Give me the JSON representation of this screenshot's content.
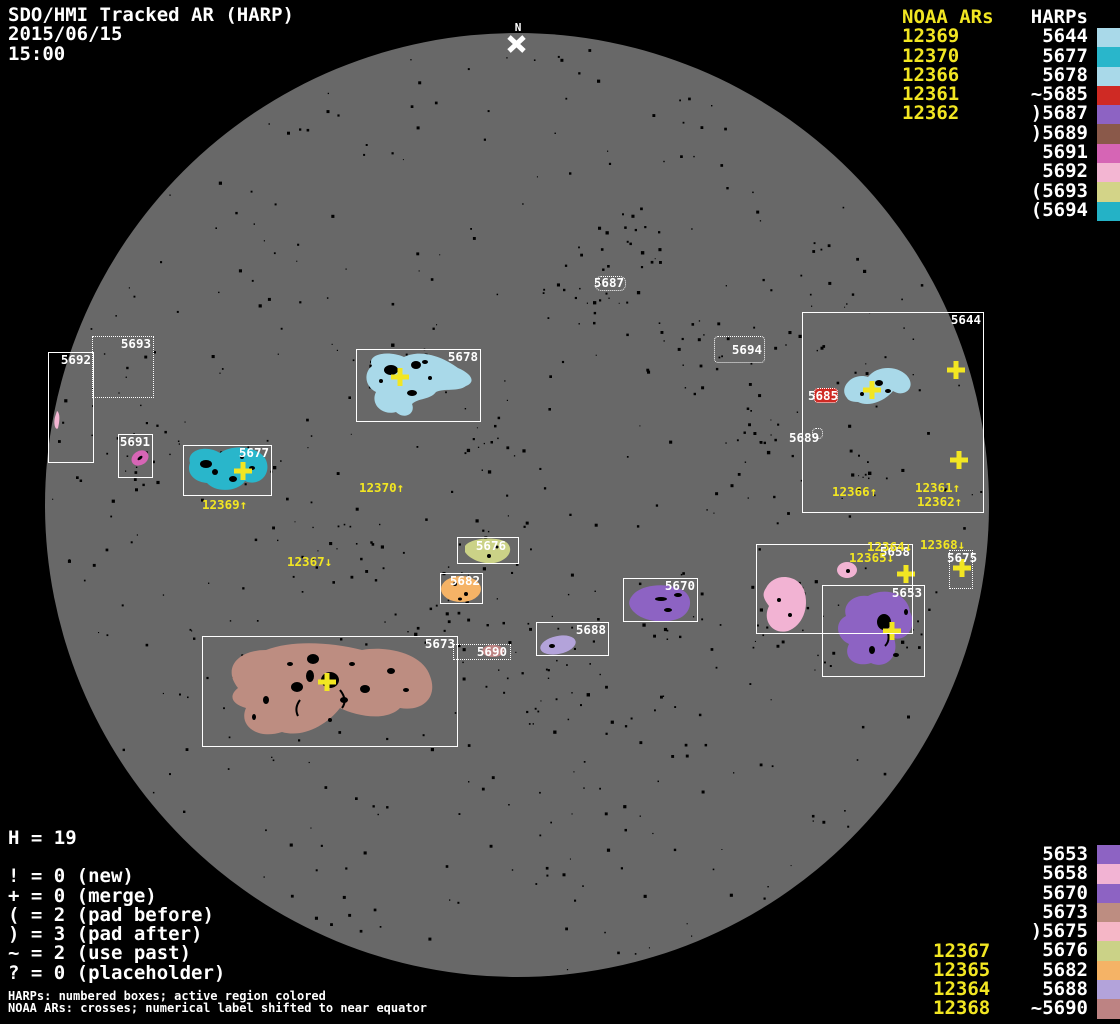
{
  "header": {
    "title": "SDO/HMI Tracked AR (HARP)",
    "date": "2015/06/15",
    "time": "15:00"
  },
  "north": {
    "label": "N"
  },
  "colors": {
    "yellow": "#f2e622",
    "white": "#ffffff",
    "disk": "#686868",
    "background": "#000000"
  },
  "legend_top": {
    "noaa_header": "NOAA ARs",
    "harps_header": "HARPs",
    "noaa": [
      "12369",
      "12370",
      "12366",
      "12361",
      "12362"
    ],
    "harps": [
      {
        "label": "5644",
        "color": "#a9d9e9"
      },
      {
        "label": "5677",
        "color": "#29b6cb"
      },
      {
        "label": "5678",
        "color": "#a9d9e9"
      },
      {
        "label": "~5685",
        "color": "#cf2a24"
      },
      {
        "label": ")5687",
        "color": "#8d63c3"
      },
      {
        "label": ")5689",
        "color": "#8a594a"
      },
      {
        "label": "5691",
        "color": "#d665b5"
      },
      {
        "label": "5692",
        "color": "#f3b5d2"
      },
      {
        "label": "(5693",
        "color": "#d3d488"
      },
      {
        "label": "(5694",
        "color": "#24b2c6"
      }
    ]
  },
  "legend_bottom": {
    "noaa": [
      "12367",
      "12365",
      "12364",
      "12368"
    ],
    "harps": [
      {
        "label": "5653",
        "color": "#8d63c3"
      },
      {
        "label": "5658",
        "color": "#f2b3d3"
      },
      {
        "label": "5670",
        "color": "#8d63c3"
      },
      {
        "label": "5673",
        "color": "#bd8d81"
      },
      {
        "label": ")5675",
        "color": "#f5b6c6"
      },
      {
        "label": "5676",
        "color": "#cbd287"
      },
      {
        "label": "5682",
        "color": "#f5b366"
      },
      {
        "label": "5688",
        "color": "#b3a3da"
      },
      {
        "label": "~5690",
        "color": "#bd8383"
      }
    ]
  },
  "stats": {
    "h": "H = 19",
    "lines": [
      "! = 0 (new)",
      "+ = 0 (merge)",
      "( = 2 (pad before)",
      ") = 3 (pad after)",
      "~ = 2 (use past)",
      "? = 0 (placeholder)"
    ]
  },
  "footer": {
    "line1": "HARPs: numbered boxes; active region colored",
    "line2": "NOAA ARs: crosses; numerical label shifted to near equator"
  },
  "boxes": {
    "b5644": {
      "label": "5644"
    },
    "b5653": {
      "label": "5653"
    },
    "b5658": {
      "label": "5658"
    },
    "b5670": {
      "label": "5670"
    },
    "b5673": {
      "label": "5673"
    },
    "b5675": {
      "label": "5675"
    },
    "b5676": {
      "label": "5676"
    },
    "b5677": {
      "label": "5677"
    },
    "b5678": {
      "label": "5678"
    },
    "b5682": {
      "label": "5682"
    },
    "b5685": {
      "label": "5685"
    },
    "b5687": {
      "label": "5687"
    },
    "b5688": {
      "label": "5688"
    },
    "b5689": {
      "label": "5689"
    },
    "b5690": {
      "label": "5690"
    },
    "b5691": {
      "label": "5691"
    },
    "b5692": {
      "label": "5692"
    },
    "b5693": {
      "label": "5693"
    },
    "b5694": {
      "label": "5694"
    }
  },
  "region_colors": {
    "5644": "#a9d9e9",
    "5653": "#8d63c3",
    "5658": "#f2b3d3",
    "5670": "#8d63c3",
    "5673": "#bd8d81",
    "5676": "#cbd287",
    "5677": "#29b6cb",
    "5678": "#a9d9e9",
    "5682": "#f5b366",
    "5685": "#cf2a24",
    "5688": "#b3a3da",
    "5690": "#bd8383",
    "5691": "#d665b5",
    "5692": "#f3b5d2"
  },
  "ar_labels": {
    "a12369": "12369↑",
    "a12370": "12370↑",
    "a12367": "12367↓",
    "a12366": "12366↑",
    "a12361": "12361↑",
    "a12362": "12362↑",
    "a12364": "12364↓",
    "a12365": "12365↓",
    "a12368": "12368↓"
  }
}
